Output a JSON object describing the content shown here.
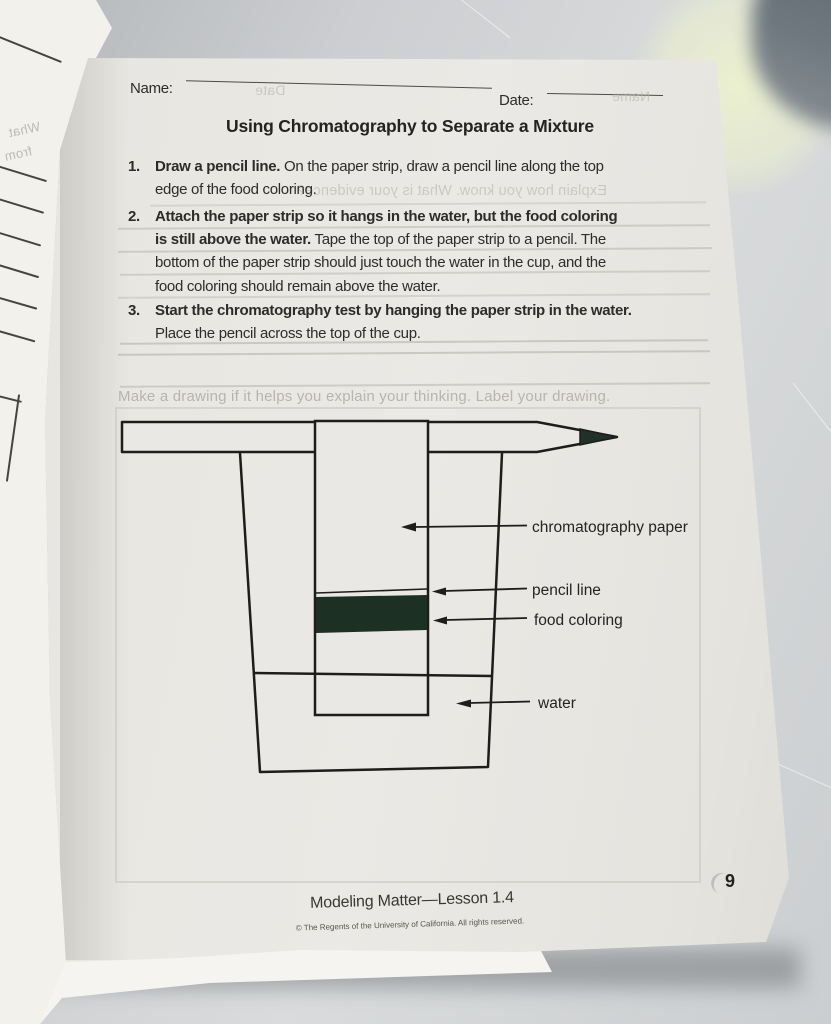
{
  "header": {
    "name_label": "Name:",
    "date_label": "Date:"
  },
  "title": "Using Chromatography to Separate a Mixture",
  "instructions": [
    {
      "num": "1.",
      "bold": "Draw a pencil line.",
      "rest": " On the paper strip, draw a pencil line along the top edge of the food coloring."
    },
    {
      "num": "2.",
      "bold": "Attach the paper strip so it hangs in the water, but the food coloring is still above the water.",
      "rest": " Tape the top of the paper strip to a pencil. The bottom of the paper strip should just touch the water in the cup, and the food coloring should remain above the water."
    },
    {
      "num": "3.",
      "bold": "Start the chromatography test by hanging the paper strip in the water.",
      "rest": " Place the pencil across the top of the cup."
    }
  ],
  "ghost": {
    "prompt": "Make a drawing if it helps you explain your thinking. Label your drawing.",
    "bleed_explain": "Explain how you know. What is your evidence?",
    "bleed_name": "Name",
    "bleed_date": "Date",
    "curl_word_1": "What",
    "curl_word_2": "from"
  },
  "diagram": {
    "labels": {
      "paper": "chromatography paper",
      "pencil_line": "pencil line",
      "food_coloring": "food coloring",
      "water": "water"
    },
    "colors": {
      "food_coloring": "#1c3024",
      "ink": "#1d1d1b"
    }
  },
  "footer": {
    "lesson": "Modeling Matter—Lesson 1.4",
    "copyright": "© The Regents of the University of California. All rights reserved.",
    "page_number": "9"
  }
}
